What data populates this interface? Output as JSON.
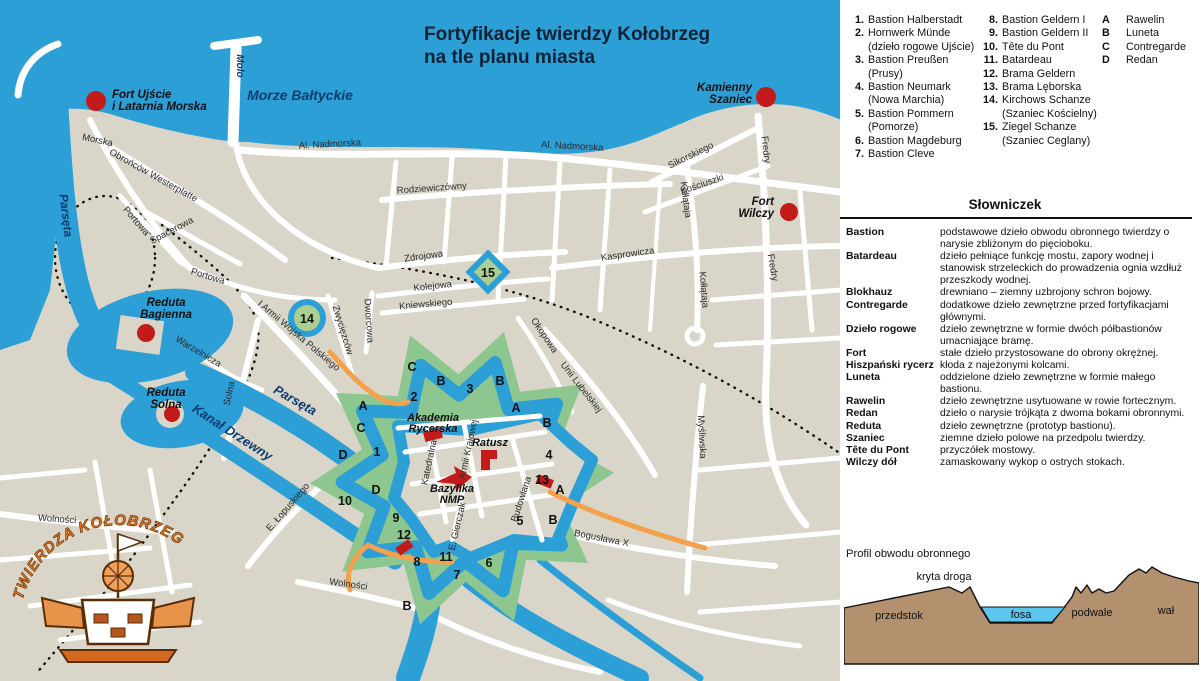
{
  "map": {
    "title_line1": "Fortyfikacje twierdzy Kołobrzeg",
    "title_line2": "na tle planu miasta",
    "logo_text": "TWIERDZA   KOŁOBRZEG",
    "water_labels": [
      {
        "t": "Morze Bałtyckie",
        "x": 300,
        "y": 100,
        "r": 0,
        "s": 14
      },
      {
        "t": "Molo",
        "x": 237,
        "y": 66,
        "r": 90,
        "s": 10
      },
      {
        "t": "Parsęta",
        "x": 62,
        "y": 216,
        "r": 83,
        "s": 12
      },
      {
        "t": "Parsęta",
        "x": 293,
        "y": 404,
        "r": 30,
        "s": 13
      },
      {
        "t": "Kanał Drzewny",
        "x": 230,
        "y": 436,
        "r": 33,
        "s": 13
      }
    ],
    "fort_sites": [
      {
        "lines": [
          "Fort Ujście",
          "i Latarnia Morska"
        ],
        "x": 112,
        "y": 98,
        "anchor": "start",
        "dot": [
          96,
          101
        ],
        "dr": 10
      },
      {
        "lines": [
          "Kamienny",
          "Szaniec"
        ],
        "x": 752,
        "y": 91,
        "anchor": "end",
        "dot": [
          766,
          97
        ],
        "dr": 10
      },
      {
        "lines": [
          "Fort",
          "Wilczy"
        ],
        "x": 774,
        "y": 205,
        "anchor": "end",
        "dot": [
          789,
          212
        ],
        "dr": 9
      },
      {
        "lines": [
          "Reduta",
          "Bagienna"
        ],
        "x": 166,
        "y": 306,
        "anchor": "middle",
        "dot": [
          146,
          333
        ],
        "dr": 9
      },
      {
        "lines": [
          "Reduta",
          "Solna"
        ],
        "x": 166,
        "y": 396,
        "anchor": "middle",
        "dot": [
          172,
          414
        ],
        "dr": 8
      }
    ],
    "city_sites": [
      {
        "lines": [
          "Akademia",
          "Rycerska"
        ],
        "x": 433,
        "y": 421
      },
      {
        "lines": [
          "Ratusz"
        ],
        "x": 490,
        "y": 446
      },
      {
        "lines": [
          "Bazylika",
          "NMP"
        ],
        "x": 452,
        "y": 492
      }
    ],
    "street_labels": [
      {
        "t": "Morska",
        "x": 97,
        "y": 143,
        "r": 12
      },
      {
        "t": "Obrońców Westerplatte",
        "x": 152,
        "y": 178,
        "r": 29
      },
      {
        "t": "Al. Nadmorska",
        "x": 330,
        "y": 147,
        "r": -3
      },
      {
        "t": "Al. Nadmorska",
        "x": 572,
        "y": 149,
        "r": 3
      },
      {
        "t": "Sikorskiego",
        "x": 692,
        "y": 158,
        "r": -26
      },
      {
        "t": "Kościuszki",
        "x": 703,
        "y": 187,
        "r": -19
      },
      {
        "t": "Kołłątaja",
        "x": 683,
        "y": 200,
        "r": 82
      },
      {
        "t": "Kołłątaja",
        "x": 701,
        "y": 290,
        "r": 85
      },
      {
        "t": "Fredry",
        "x": 763,
        "y": 150,
        "r": 84
      },
      {
        "t": "Fredry",
        "x": 770,
        "y": 268,
        "r": 80
      },
      {
        "t": "Rodziewiczówny",
        "x": 432,
        "y": 191,
        "r": -4
      },
      {
        "t": "Spacerowa",
        "x": 173,
        "y": 233,
        "r": -28
      },
      {
        "t": "Portowa",
        "x": 134,
        "y": 223,
        "r": 49
      },
      {
        "t": "Portowa",
        "x": 207,
        "y": 279,
        "r": 17
      },
      {
        "t": "Zdrojowa",
        "x": 424,
        "y": 259,
        "r": -8
      },
      {
        "t": "Kolejowa",
        "x": 433,
        "y": 289,
        "r": -6
      },
      {
        "t": "Kniewskiego",
        "x": 426,
        "y": 307,
        "r": -5
      },
      {
        "t": "Kasprowicza",
        "x": 628,
        "y": 257,
        "r": -8
      },
      {
        "t": "Dworcowa",
        "x": 366,
        "y": 321,
        "r": 86
      },
      {
        "t": "Zwycięzców",
        "x": 340,
        "y": 331,
        "r": 73
      },
      {
        "t": "I Armii Wojska Polskiego",
        "x": 297,
        "y": 338,
        "r": 40
      },
      {
        "t": "Okopowa",
        "x": 542,
        "y": 337,
        "r": 56
      },
      {
        "t": "Unii Lubelskiej",
        "x": 579,
        "y": 389,
        "r": 52
      },
      {
        "t": "Warzelnicza",
        "x": 197,
        "y": 354,
        "r": 31
      },
      {
        "t": "Solna",
        "x": 232,
        "y": 394,
        "r": -78
      },
      {
        "t": "Myśliwska",
        "x": 699,
        "y": 437,
        "r": 87
      },
      {
        "t": "Bogusława X",
        "x": 601,
        "y": 541,
        "r": 11
      },
      {
        "t": "E. Łopuskiego",
        "x": 290,
        "y": 509,
        "r": -49
      },
      {
        "t": "Wolności",
        "x": 57,
        "y": 522,
        "r": 4
      },
      {
        "t": "Wolności",
        "x": 348,
        "y": 587,
        "r": 8
      },
      {
        "t": "Katedralna",
        "x": 432,
        "y": 463,
        "r": -78
      },
      {
        "t": "Armii Krajowej",
        "x": 471,
        "y": 450,
        "r": -78
      },
      {
        "t": "E. Gierczak",
        "x": 460,
        "y": 527,
        "r": -77
      },
      {
        "t": "Budowlana",
        "x": 524,
        "y": 500,
        "r": -72
      }
    ],
    "markers": [
      {
        "t": "1",
        "x": 377,
        "y": 456
      },
      {
        "t": "2",
        "x": 414,
        "y": 401
      },
      {
        "t": "3",
        "x": 470,
        "y": 393
      },
      {
        "t": "4",
        "x": 549,
        "y": 459
      },
      {
        "t": "5",
        "x": 520,
        "y": 525
      },
      {
        "t": "6",
        "x": 489,
        "y": 567
      },
      {
        "t": "7",
        "x": 457,
        "y": 579
      },
      {
        "t": "8",
        "x": 417,
        "y": 566
      },
      {
        "t": "9",
        "x": 396,
        "y": 522
      },
      {
        "t": "10",
        "x": 345,
        "y": 505
      },
      {
        "t": "11",
        "x": 446,
        "y": 561
      },
      {
        "t": "12",
        "x": 404,
        "y": 539
      },
      {
        "t": "13",
        "x": 542,
        "y": 484
      },
      {
        "t": "14",
        "x": 307,
        "y": 323
      },
      {
        "t": "15",
        "x": 488,
        "y": 277
      },
      {
        "t": "A",
        "x": 363,
        "y": 410
      },
      {
        "t": "A",
        "x": 516,
        "y": 412
      },
      {
        "t": "A",
        "x": 560,
        "y": 494
      },
      {
        "t": "B",
        "x": 441,
        "y": 385
      },
      {
        "t": "B",
        "x": 500,
        "y": 385
      },
      {
        "t": "B",
        "x": 547,
        "y": 427
      },
      {
        "t": "B",
        "x": 553,
        "y": 524
      },
      {
        "t": "B",
        "x": 407,
        "y": 610
      },
      {
        "t": "C",
        "x": 412,
        "y": 371
      },
      {
        "t": "C",
        "x": 361,
        "y": 432
      },
      {
        "t": "D",
        "x": 343,
        "y": 459
      },
      {
        "t": "D",
        "x": 376,
        "y": 494
      }
    ]
  },
  "panel": {
    "legend": {
      "col1": [
        {
          "num": "1.",
          "lines": [
            "Bastion Halberstadt"
          ]
        },
        {
          "num": "2.",
          "lines": [
            "Hornwerk Münde",
            "(dzieło rogowe Ujście)"
          ]
        },
        {
          "num": "3.",
          "lines": [
            "Bastion Preußen",
            "(Prusy)"
          ]
        },
        {
          "num": "4.",
          "lines": [
            "Bastion Neumark",
            "(Nowa Marchia)"
          ]
        },
        {
          "num": "5.",
          "lines": [
            "Bastion Pommern",
            "(Pomorze)"
          ]
        },
        {
          "num": "6.",
          "lines": [
            "Bastion Magdeburg"
          ]
        },
        {
          "num": "7.",
          "lines": [
            "Bastion Cleve"
          ]
        }
      ],
      "col2": [
        {
          "num": "8.",
          "lines": [
            "Bastion Geldern I"
          ]
        },
        {
          "num": "9.",
          "lines": [
            "Bastion Geldern II"
          ]
        },
        {
          "num": "10.",
          "lines": [
            "Tête du Pont"
          ]
        },
        {
          "num": "11.",
          "lines": [
            "Batardeau"
          ]
        },
        {
          "num": "12.",
          "lines": [
            "Brama Geldern"
          ]
        },
        {
          "num": "13.",
          "lines": [
            "Brama Lęborska"
          ]
        },
        {
          "num": "14.",
          "lines": [
            "Kirchows Schanze",
            "(Szaniec Kościelny)"
          ]
        },
        {
          "num": "15.",
          "lines": [
            "Ziegel Schanze",
            "(Szaniec Ceglany)"
          ]
        }
      ],
      "col3": [
        {
          "num": "A",
          "lines": [
            "Rawelin"
          ]
        },
        {
          "num": "B",
          "lines": [
            "Luneta"
          ]
        },
        {
          "num": "C",
          "lines": [
            "Contregarde"
          ]
        },
        {
          "num": "D",
          "lines": [
            "Redan"
          ]
        }
      ]
    },
    "glossary": {
      "title": "Słowniczek",
      "entries": [
        {
          "term": "Bastion",
          "def": "podstawowe dzieło obwodu obronnego twierdzy o narysie zbliżonym do pięcioboku."
        },
        {
          "term": "Batardeau",
          "def": "dzieło pełniące funkcję mostu, zapory wodnej i stanowisk strzeleckich do prowadzenia ognia wzdłuż przeszkody wodnej."
        },
        {
          "term": "Blokhauz",
          "def": "drewniano – ziemny uzbrojony schron bojowy."
        },
        {
          "term": "Contregarde",
          "def": "dodatkowe dzieło zewnętrzne przed fortyfikacjami głównymi."
        },
        {
          "term": "Dzieło rogowe",
          "def": "dzieło zewnętrzne w formie dwóch półbastionów umacniające bramę."
        },
        {
          "term": "Fort",
          "def": "stałe dzieło przystosowane do obrony okrężnej."
        },
        {
          "term": "Hiszpański rycerz",
          "def": "kłoda z najeżonymi kolcami."
        },
        {
          "term": "Luneta",
          "def": "oddzielone dzieło zewnętrzne w formie małego bastionu."
        },
        {
          "term": "Rawelin",
          "def": "dzieło zewnętrzne usytuowane w rowie fortecznym."
        },
        {
          "term": "Redan",
          "def": "dzieło o narysie trójkąta z dwoma bokami obronnymi."
        },
        {
          "term": "Reduta",
          "def": "dzieło zewnętrzne (prototyp bastionu)."
        },
        {
          "term": "Szaniec",
          "def": "ziemne dzieło polowe na przedpolu twierdzy."
        },
        {
          "term": "Tête du Pont",
          "def": "przyczółek mostowy."
        },
        {
          "term": "Wilczy dół",
          "def": "zamaskowany wykop o ostrych stokach."
        }
      ]
    },
    "profile": {
      "title": "Profil obwodu obronnego",
      "label_kryta": "kryta droga",
      "label_przedstok": "przedstok",
      "label_fosa": "fosa",
      "label_podwale": "podwale",
      "label_wal": "wał"
    }
  },
  "colors": {
    "sea": "#2b9fd6",
    "land": "#d9d6c9",
    "street": "#ffffff",
    "green": "#8dc78f",
    "lunette_green": "#aacf90",
    "red": "#c31a1a",
    "orange": "#f3a14d",
    "navy": "#0b3d70",
    "title_navy": "#0d2235",
    "brown": "#b3906e",
    "fosa_blue": "#5ec6ee",
    "logo_orange": "#e0761f"
  }
}
